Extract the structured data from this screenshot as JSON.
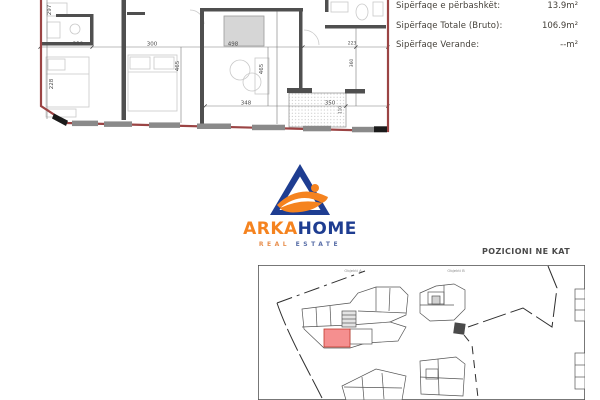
{
  "info_panel": {
    "rows": [
      {
        "label": "Sipërfaqe e përbashkët:",
        "value": "13.9m²"
      },
      {
        "label": "Sipërfaqe Totale (Bruto):",
        "value": "106.9m²"
      },
      {
        "label": "Sipërfaqe Verande:",
        "value": "--m²"
      }
    ]
  },
  "logo": {
    "brand_orange": "ARKA",
    "brand_blue": "HOME",
    "tagline_left": "REAL",
    "tagline_right": "ESTATE"
  },
  "floor_plan": {
    "dims": {
      "w339": "339",
      "w300": "300",
      "w498": "498",
      "w223": "223",
      "w348": "348",
      "w350": "350",
      "h297": "297",
      "h228": "228",
      "h465a": "465",
      "h465b": "465",
      "h360": "360",
      "h110": "110"
    }
  },
  "site_plan": {
    "title": "POZICIONI NE KAT",
    "building_a_label": "Objekti A",
    "building_b_label": "Objekti B"
  },
  "colors": {
    "plan_outline": "#9b4444",
    "wall": "#4f4f4f",
    "logo_blue": "#1e3d91",
    "logo_orange": "#f5831f",
    "highlight_unit": "#f58f8f"
  }
}
